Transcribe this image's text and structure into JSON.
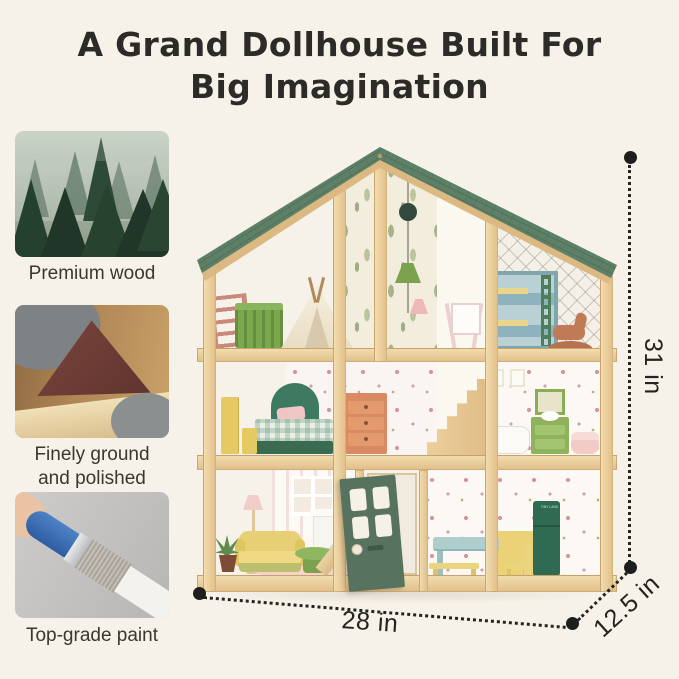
{
  "colors": {
    "background": "#f6f2e9",
    "title_text": "#2c2b27",
    "caption_text": "#393730",
    "dimension_text": "#232321",
    "roof_green": "#5e8066",
    "roof_green_dark": "#4f7158",
    "wood_light": "#f2dcae",
    "wood_dark": "#e2c08b",
    "wood_edge": "#c9a36b",
    "door_green": "#57735f",
    "fridge_green": "#2f6b52",
    "floor_terracotta": "#d89d6c",
    "dot_black": "#1e1e1c"
  },
  "title": {
    "line1": "A Grand Dollhouse Built For",
    "line2": "Big Imagination"
  },
  "features": [
    {
      "photo": "misty-evergreen-forest",
      "caption_line1": "Premium wood",
      "caption_line2": ""
    },
    {
      "photo": "sandpaper-smoothing-wood",
      "caption_line1": "Finely ground",
      "caption_line2": "and polished"
    },
    {
      "photo": "brush-applying-white-paint",
      "caption_line1": "Top-grade paint",
      "caption_line2": ""
    }
  ],
  "dimensions": {
    "height_label": "31 in",
    "width_label": "28 in",
    "depth_label": "12.5 in"
  },
  "dollhouse": {
    "fridge_label": "TINY LAND"
  }
}
